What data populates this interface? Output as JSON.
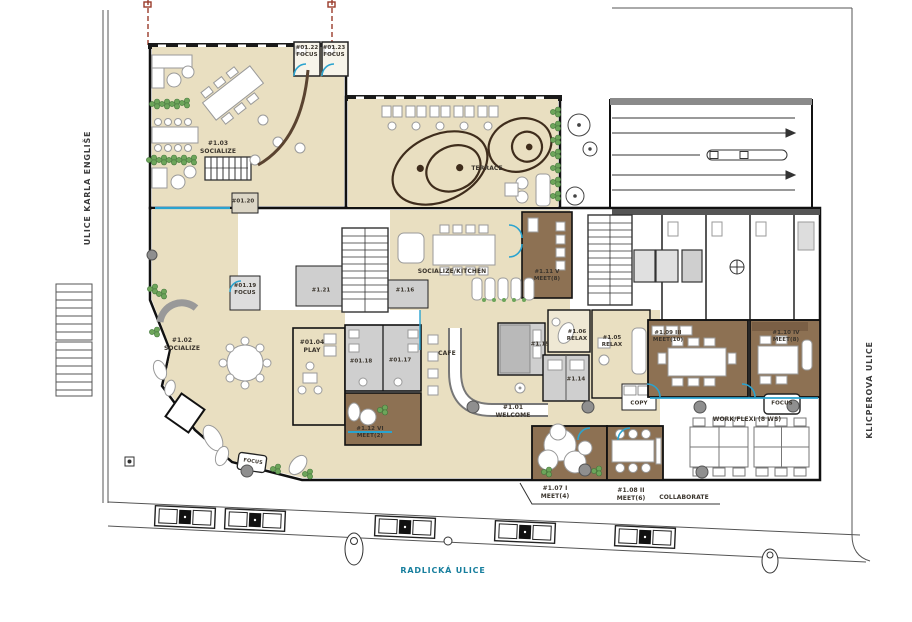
{
  "plan": {
    "streets": {
      "left": "ULICE KARLA ENGLIŠE",
      "right": "KLICPEROVA ULICE",
      "bottom": "RADLICKÁ ULICE"
    },
    "rooms": {
      "focus_0122": {
        "id": "#01.22",
        "name": "FOCUS"
      },
      "focus_0123": {
        "id": "#01.23",
        "name": "FOCUS"
      },
      "socialize_0103": {
        "id": "#1.03",
        "name": "SOCIALIZE"
      },
      "room_0120": {
        "id": "#01.20",
        "name": ""
      },
      "room_0121": {
        "id": "#1.21",
        "name": ""
      },
      "room_0116": {
        "id": "#1.16",
        "name": ""
      },
      "meet_0111": {
        "id": "#1.11 V",
        "name": "MEET(8)"
      },
      "focus_0119": {
        "id": "#01.19",
        "name": "FOCUS"
      },
      "socialize_0102": {
        "id": "#1.02",
        "name": "SOCIALIZE"
      },
      "play_0104": {
        "id": "#01.04",
        "name": "PLAY"
      },
      "room_0118": {
        "id": "#01.18",
        "name": ""
      },
      "room_0117": {
        "id": "#01.17",
        "name": ""
      },
      "meet_0112": {
        "id": "#1.12 VI",
        "name": "MEET(2)"
      },
      "room_0115": {
        "id": "#1.15",
        "name": ""
      },
      "relax_0106": {
        "id": "#1.06",
        "name": "RELAX"
      },
      "relax_0105": {
        "id": "#1.05",
        "name": "RELAX"
      },
      "room_0114": {
        "id": "#1.14",
        "name": ""
      },
      "meet_0109": {
        "id": "#1.09 III",
        "name": "MEET(10)"
      },
      "meet_0110": {
        "id": "#1.10 IV",
        "name": "MEET(8)"
      },
      "welcome_0101": {
        "id": "#1.01",
        "name": "WELCOME"
      },
      "meet_0107": {
        "id": "#1.07 I",
        "name": "MEET(4)"
      },
      "meet_0108": {
        "id": "#1.08 II",
        "name": "MEET(6)"
      }
    },
    "areas": {
      "terrace": "TERRACE",
      "kitchen": "SOCIALIZE/KITCHEN",
      "cafe": "CAFE",
      "copy": "COPY",
      "work_flexi": "WORK/FLEXI  (8 WS)",
      "focus_booth_work": "FOCUS",
      "focus_booth_welcome": "FOCUS",
      "collaborate": "COLLABORATE"
    },
    "colors": {
      "room_beige": "#e9dfc1",
      "room_brown": "#8d7153",
      "room_gray": "#cfcfcf",
      "accent_blue": "#2aa3cf",
      "plant_green": "#6da55a",
      "street_label_teal": "#187f9e",
      "survey_red": "#9a3b2b"
    }
  }
}
